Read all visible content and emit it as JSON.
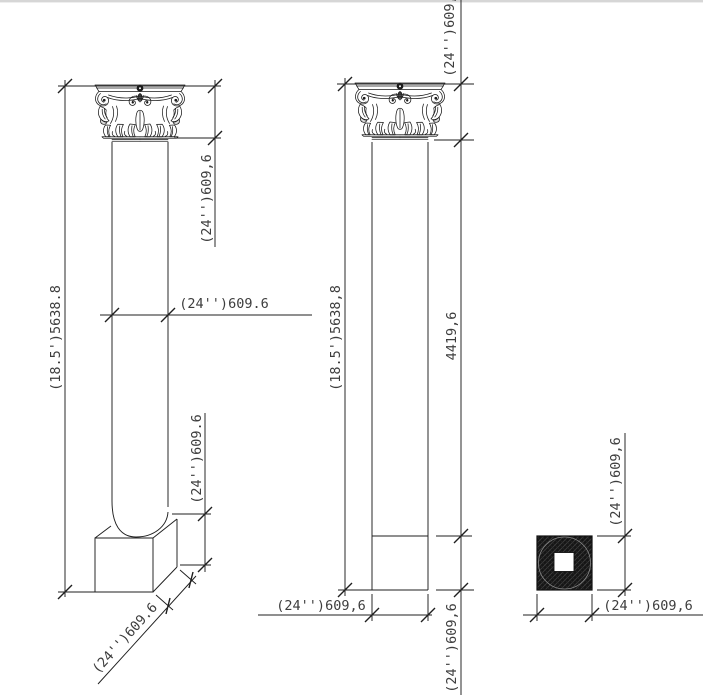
{
  "drawing": {
    "left_column": {
      "overall_height": "(18.5')5638.8",
      "capital_height": "(24'')609,6",
      "shaft_diameter": "(24'')609.6",
      "base_height": "(24'')609.6",
      "base_diagonal_width": "(24'')609.6"
    },
    "middle_column": {
      "overall_height": "(18.5')5638,8",
      "capital_height": "(24'')609,6",
      "shaft_height": "4419,6",
      "base_width": "(24'')609,6",
      "base_height": "(24'')609,6"
    },
    "plan_view": {
      "width": "(24'')609,6",
      "depth": "(24'')609,6"
    },
    "colors": {
      "background": "#ffffff",
      "line": "#1f1f1f",
      "dimension_text": "#3d3d3d",
      "hatch_fill": "#151515"
    }
  }
}
